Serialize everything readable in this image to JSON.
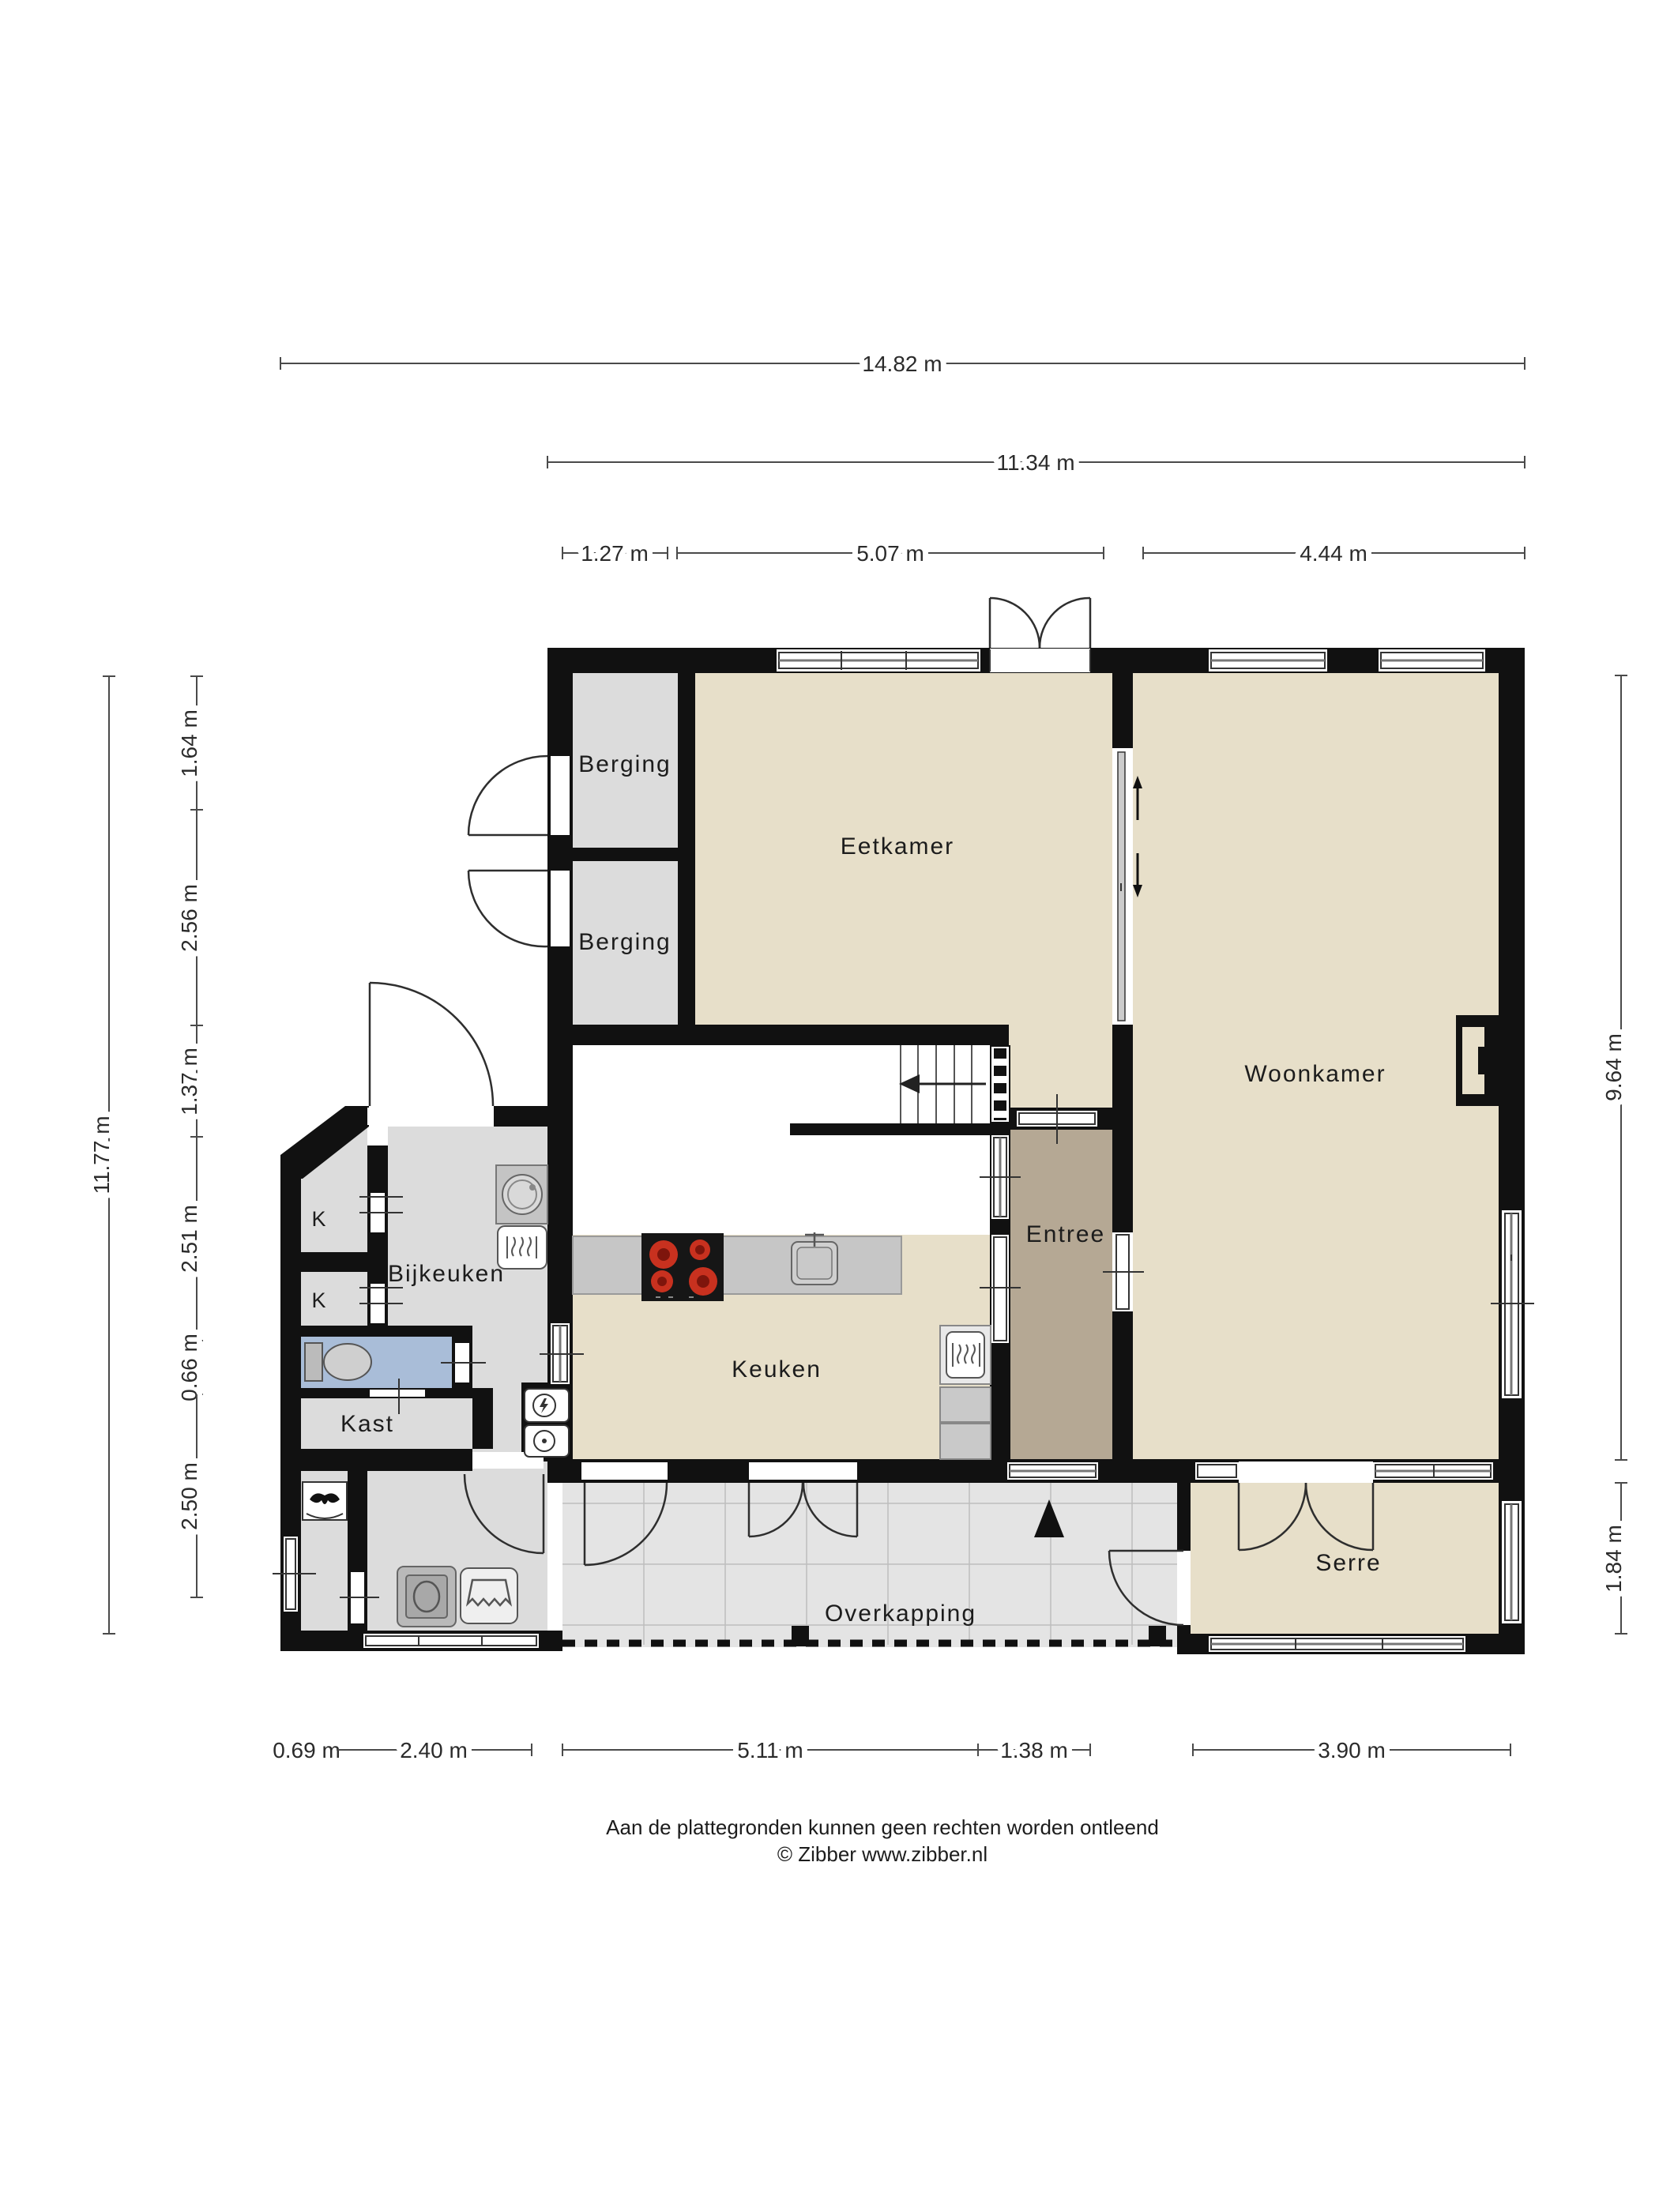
{
  "title": "Begane grond plattegrond",
  "rooms": {
    "berging1": {
      "label": "Berging"
    },
    "berging2": {
      "label": "Berging"
    },
    "eetkamer": {
      "label": "Eetkamer"
    },
    "woonkamer": {
      "label": "Woonkamer"
    },
    "bijkeuken": {
      "label": "Bijkeuken"
    },
    "keuken": {
      "label": "Keuken"
    },
    "entree": {
      "label": "Entree"
    },
    "kast": {
      "label": "Kast"
    },
    "k1": {
      "label": "K"
    },
    "k2": {
      "label": "K"
    },
    "overkapping": {
      "label": "Overkapping"
    },
    "serre": {
      "label": "Serre"
    }
  },
  "dimensions": {
    "top_total": {
      "label": "14.82 m"
    },
    "top_main": {
      "label": "11.34 m"
    },
    "top_chain": [
      {
        "label": "1.27 m"
      },
      {
        "label": "5.07 m"
      },
      {
        "label": "4.44 m"
      }
    ],
    "left_total": {
      "label": "11.77 m"
    },
    "left_chain": [
      {
        "label": "1.64 m"
      },
      {
        "label": "2.56 m"
      },
      {
        "label": "1.37 m"
      },
      {
        "label": "2.51 m"
      },
      {
        "label": "0.66 m"
      },
      {
        "label": "2.50 m"
      }
    ],
    "right_chain": [
      {
        "label": "9.64 m"
      },
      {
        "label": "1.84 m"
      }
    ],
    "bottom_chain": [
      {
        "label": "0.69 m"
      },
      {
        "label": "2.40 m"
      },
      {
        "label": "5.11 m"
      },
      {
        "label": "1.38 m"
      },
      {
        "label": "3.90 m"
      }
    ]
  },
  "icons": {
    "north_arrow": "north-arrow",
    "stairs_arrow": "stairs-direction-arrow",
    "wc": "toilet-icon",
    "washer": "washing-machine-icon",
    "dryer": "dryer-icon",
    "laundry_basket": "laundry-basket-icon",
    "stove": "cooktop-icon",
    "sink": "kitchen-sink-icon",
    "oven": "oven-icon",
    "mv_unit": "mechanical-ventilation-icon",
    "meter1": "electric-meter-icon",
    "meter2": "water-meter-icon"
  },
  "colors": {
    "wall": "#111111",
    "floor_living": "#e7dfc9",
    "floor_storage": "#dcdcdc",
    "floor_entree": "#b5a894",
    "floor_toilet": "#a9bdd8",
    "floor_overkapping": "#e4e4e4",
    "counter": "#c6c6c6",
    "burner_red": "#c8311f"
  },
  "footer": {
    "line1": "Aan de plattegronden kunnen geen rechten worden ontleend",
    "line2": "© Zibber www.zibber.nl"
  }
}
